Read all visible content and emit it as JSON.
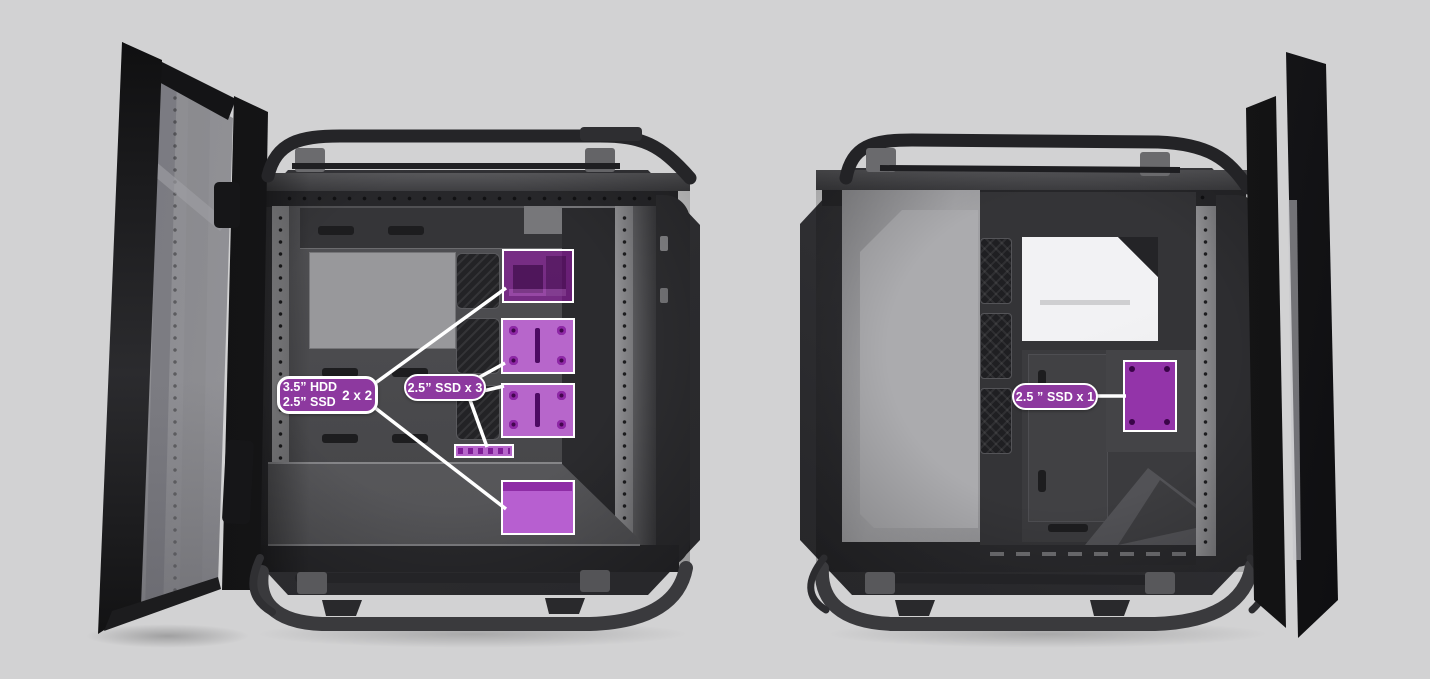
{
  "image": {
    "subject": "PC tower case shown from both sides with panels open; purple highlights mark drive mounting locations",
    "background_color": "#d2d2d3",
    "accent": {
      "callout_fill": "#8d399f",
      "callout_border": "#ffffff",
      "callout_text": "#ffffff",
      "highlight_fill_light": "#b766cb",
      "highlight_fill_dark": "#9334a9",
      "connector_line": "#ffffff"
    }
  },
  "left_view": {
    "name": "main-chamber-side-open",
    "callouts": [
      {
        "id": "hdd-ssd-combo",
        "line1": "3.5” HDD",
        "line2": "2.5” SSD",
        "quantity": "2 x 2",
        "targets": [
          "drive-cage-highlight",
          "psu-shroud-mount-highlight"
        ]
      },
      {
        "id": "ssd-x3",
        "label": "2.5” SSD x 3",
        "targets": [
          "ssd-tray-upper-highlight",
          "ssd-tray-lower-highlight",
          "ssd-bracket-strip-highlight"
        ]
      }
    ]
  },
  "right_view": {
    "name": "behind-motherboard-side-open",
    "callouts": [
      {
        "id": "ssd-x1",
        "label": "2.5 ” SSD x 1",
        "targets": [
          "rear-ssd-mount-highlight"
        ]
      }
    ]
  }
}
